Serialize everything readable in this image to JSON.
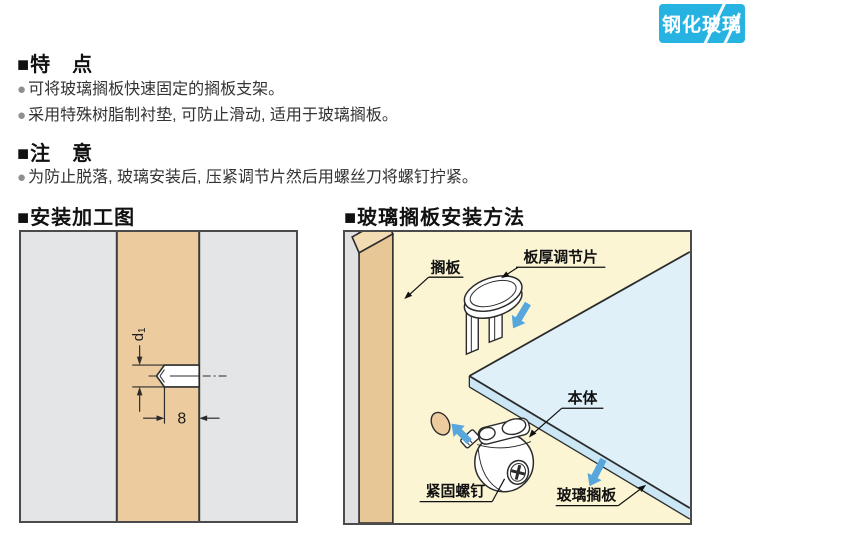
{
  "badge": {
    "label": "钢化玻璃"
  },
  "bullet_char": "●",
  "features": {
    "heading": "■特　点",
    "items": [
      "可将玻璃搁板快速固定的搁板支架。",
      "采用特殊树脂制衬垫, 可防止滑动, 适用于玻璃搁板。"
    ]
  },
  "note": {
    "heading": "■注　意",
    "items": [
      "为防止脱落, 玻璃安装后, 压紧调节片然后用螺丝刀将螺钉拧紧。"
    ]
  },
  "install_diagram": {
    "heading": "■安装加工图",
    "dims": {
      "depth": "8",
      "dia": "d",
      "dia_sub": "1"
    }
  },
  "method_diagram": {
    "heading": "■玻璃搁板安装方法",
    "labels": {
      "shelf": "搁板",
      "adjuster": "板厚调节片",
      "body": "本体",
      "screw": "紧固螺钉",
      "glass": "玻璃搁板"
    }
  },
  "colors": {
    "badge_bg": "#27B3E2",
    "arrow_blue": "#58A7DC",
    "wood": "#ECCB9F",
    "wood_front": "#E7C795",
    "wood_top": "#F2DCB3",
    "glass_top": "#DFF0F9",
    "glass_edge": "#CBE6F4",
    "cream_bg": "#FBF5D4",
    "panel_gray": "#E4E5E7",
    "strip_gray": "#E0E1E3"
  }
}
